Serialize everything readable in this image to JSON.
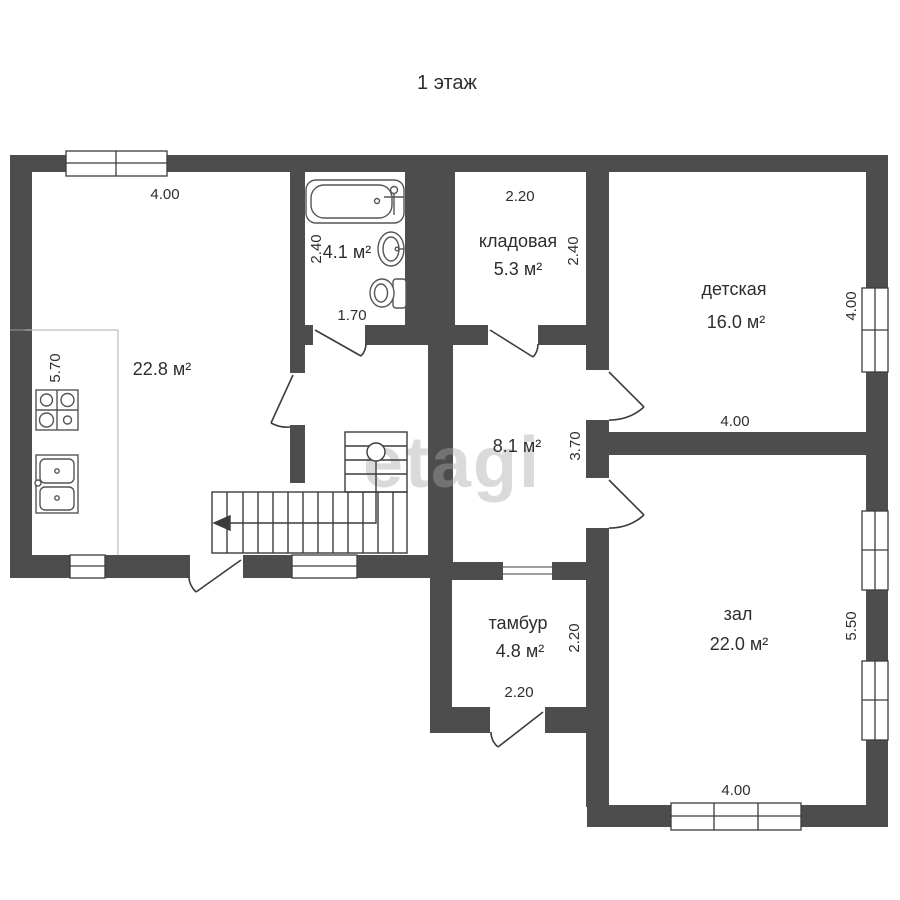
{
  "title": "1 этаж",
  "watermark": "etagi",
  "colors": {
    "wall": "#4d4d4d",
    "line": "#3c3c3c",
    "light_line": "#c9c9c9",
    "text": "#2e2e2e",
    "background": "#ffffff",
    "watermark": "#d9d9d9"
  },
  "rooms": {
    "kitchen": {
      "area": "22.8 м²"
    },
    "bathroom": {
      "area": "4.1 м²"
    },
    "storage": {
      "name": "кладовая",
      "area": "5.3 м²"
    },
    "children": {
      "name": "детская",
      "area": "16.0 м²"
    },
    "hall": {
      "area": "8.1 м²"
    },
    "vestibule": {
      "name": "тамбур",
      "area": "4.8 м²"
    },
    "living": {
      "name": "зал",
      "area": "22.0 м²"
    }
  },
  "dimensions": {
    "kitchen_top": "4.00",
    "kitchen_left": "5.70",
    "bathroom_left": "2.40",
    "bathroom_bottom": "1.70",
    "storage_top": "2.20",
    "storage_right": "2.40",
    "children_right": "4.00",
    "children_bottom": "4.00",
    "hall_right": "3.70",
    "vestibule_right": "2.20",
    "vestibule_bottom": "2.20",
    "living_right": "5.50",
    "living_bottom": "4.00"
  }
}
